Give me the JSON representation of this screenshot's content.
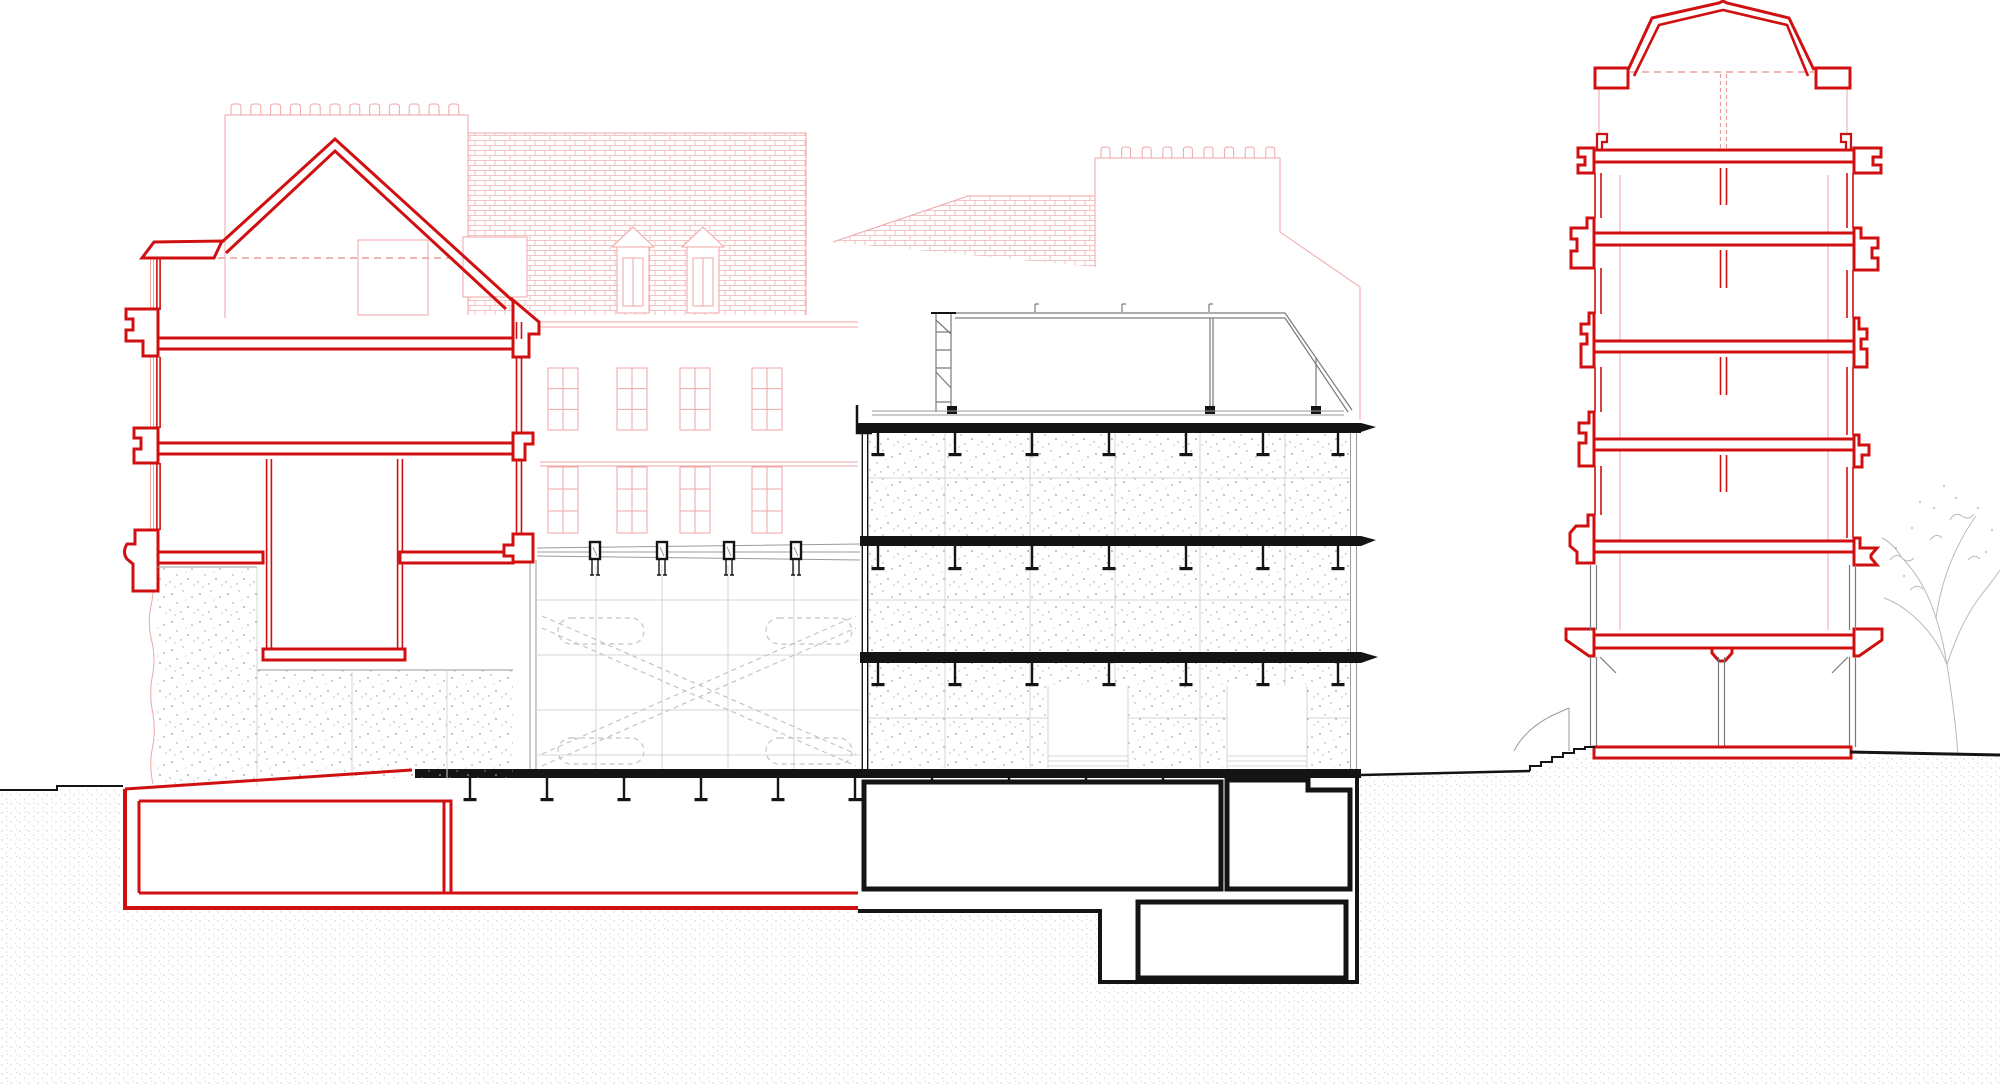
{
  "drawing": {
    "title": "Architectural cross-section drawing with existing buildings (red), new middle building (black) and background elevation (pink)"
  },
  "colors": {
    "section_red": "#d01010",
    "faint_pink": "#f0a6a6",
    "brick_pink": "#eeb3b3",
    "ink_black": "#141414",
    "mid_gray": "#7a7a7a",
    "light_gray": "#d6d6d6",
    "dash_gray": "#c4c4c4",
    "concrete_dot": "#9a9a9a",
    "ground_dot": "#c9c9c9",
    "tree_gray": "#b9b9b9",
    "dash_red": "#ea9c9c"
  },
  "semantics": {
    "red_lines": "sectioned masonry buildings",
    "black_lines": "sectioned middle building and basement",
    "pink_lines": "background street elevation",
    "gray_lines": "elements beyond the section plane",
    "stipple": "ground / concrete hatch"
  },
  "generated": {
    "p1_merlons": {
      "x_start": 231,
      "step": 19.8,
      "count": 12,
      "y_top": 104,
      "y_base": 115,
      "w": 10
    },
    "p2_merlons": {
      "x_start": 1101,
      "step": 20.6,
      "count": 9,
      "y_top": 147,
      "y_base": 158,
      "w": 9
    },
    "p1_windows": {
      "cols": [
        548,
        617,
        680,
        752
      ],
      "w": 30,
      "rows": [
        {
          "y": 368,
          "h": 62
        },
        {
          "y": 467,
          "h": 66
        }
      ]
    },
    "wall_joints": {
      "x_left": 536,
      "x_right": 860,
      "y_top": 565,
      "y_bottom": 769,
      "x_lines": [
        596,
        662,
        728,
        794
      ],
      "y_lines": [
        600,
        655,
        710,
        755
      ]
    },
    "concrete_joints": {
      "x_left": 868,
      "x_right": 1350,
      "x_lines": [
        945,
        1030,
        1115,
        1200,
        1285
      ],
      "y_bands": [
        [
          433,
          536
        ],
        [
          546,
          652
        ],
        [
          663,
          768
        ]
      ],
      "y_lines": [
        478,
        600,
        718
      ]
    },
    "tie_rods": {
      "x1": 537,
      "x2": 860,
      "lines": [
        [
          548,
          544
        ],
        [
          552,
          552
        ],
        [
          556,
          560
        ]
      ]
    },
    "tie_anchors": {
      "xs": [
        595,
        662,
        729,
        796
      ],
      "y_top": 542,
      "h": 17,
      "half_w": 5,
      "leg_dx": 3,
      "leg_y2": 575
    },
    "hanger": {
      "stem_len": 21,
      "flange_w": 13,
      "flange_t": 3.2,
      "stem_w": 2.4
    },
    "hanger_rows": [
      {
        "y_top": 432,
        "xs": [
          878,
          955,
          1032,
          1109,
          1186,
          1263,
          1338
        ]
      },
      {
        "y_top": 546,
        "xs": [
          878,
          955,
          1032,
          1109,
          1186,
          1263,
          1338
        ]
      },
      {
        "y_top": 662,
        "xs": [
          878,
          955,
          1032,
          1109,
          1186,
          1263,
          1338
        ]
      },
      {
        "y_top": 777,
        "xs": [
          470,
          547,
          624,
          701,
          778,
          855,
          932,
          1009,
          1086,
          1163,
          1240
        ]
      }
    ],
    "tower_stubs": {
      "x1": 1720.5,
      "x2": 1726.5,
      "spans": [
        [
          168,
          205
        ],
        [
          250,
          288
        ],
        [
          357,
          395
        ],
        [
          455,
          492
        ]
      ]
    },
    "pavilion_tabs": {
      "xs": [
        1035,
        1122,
        1209
      ],
      "y1": 304,
      "y2": 312
    }
  }
}
